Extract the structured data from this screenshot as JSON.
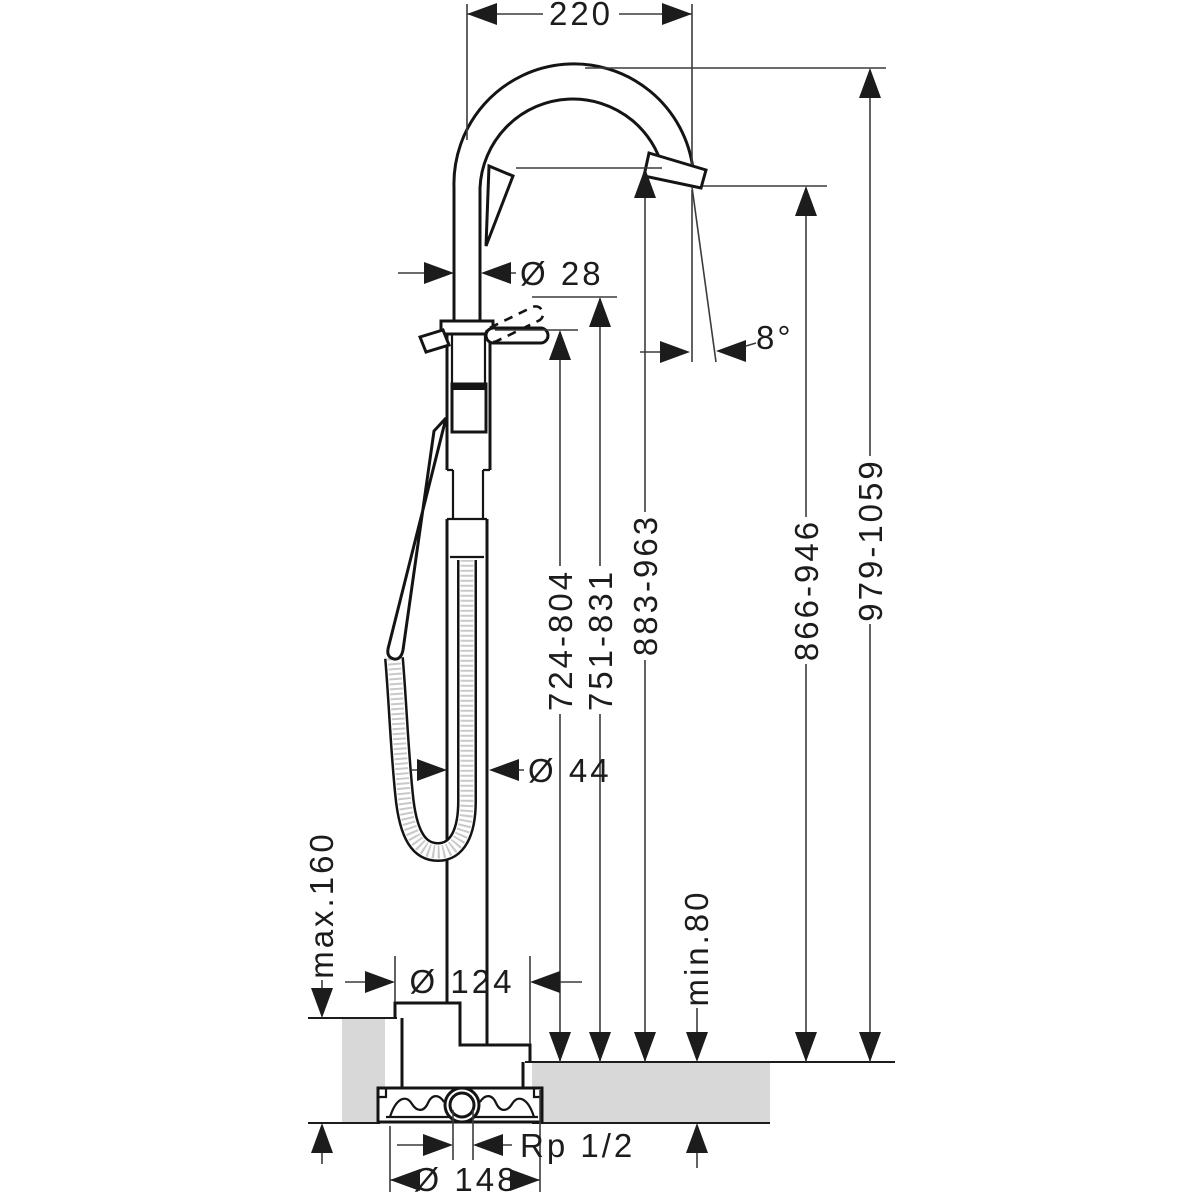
{
  "drawing": {
    "kind": "technical-dimension-drawing",
    "colors": {
      "line": "#141414",
      "dimension_line": "#3c3c3c",
      "floor_fill": "#d8d8d8",
      "background": "#ffffff"
    },
    "dimensions": {
      "spout_reach": "220",
      "spout_pipe_diameter": "Ø 28",
      "spout_angle": "8°",
      "lever_height": "724-804",
      "lever_raised_height": "751-831",
      "spout_underside_height": "883-963",
      "outlet_height": "866-946",
      "overall_height": "979-1059",
      "pillar_diameter": "Ø 44",
      "max_floor_buildup": "max.160",
      "escutcheon_diameter": "Ø 124",
      "min_floor_thickness": "min.80",
      "connection_thread": "Rp 1/2",
      "basic_set_diameter": "Ø 148"
    }
  }
}
